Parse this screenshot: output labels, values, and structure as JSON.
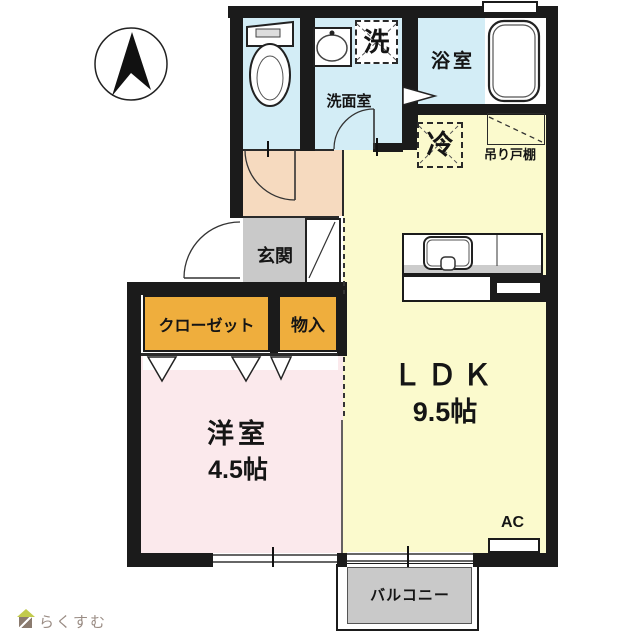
{
  "plan": {
    "labels": {
      "washer": "洗",
      "washroom": "洗面室",
      "bathroom": "浴室",
      "fridge": "冷",
      "hanging_cupboard": "吊り戸棚",
      "entrance": "玄関",
      "closet": "クローゼット",
      "storage": "物入",
      "ldk": "ＬＤＫ",
      "ldk_size": "9.5帖",
      "western_room": "洋室",
      "western_room_size": "4.5帖",
      "ac": "AC",
      "balcony": "バルコニー"
    },
    "colors": {
      "wet_room_blue": "#d3edf6",
      "hallway_peach": "#f6dabf",
      "entrance_gray": "#c9c9c9",
      "ldk_yellow": "#fbfacd",
      "bedroom_pink": "#fbe9ec",
      "closet_orange": "#efae3d",
      "balcony_gray": "#c9c9c9",
      "wall_black": "#1b1b1b"
    }
  },
  "footer": {
    "brand": "らくすむ"
  }
}
